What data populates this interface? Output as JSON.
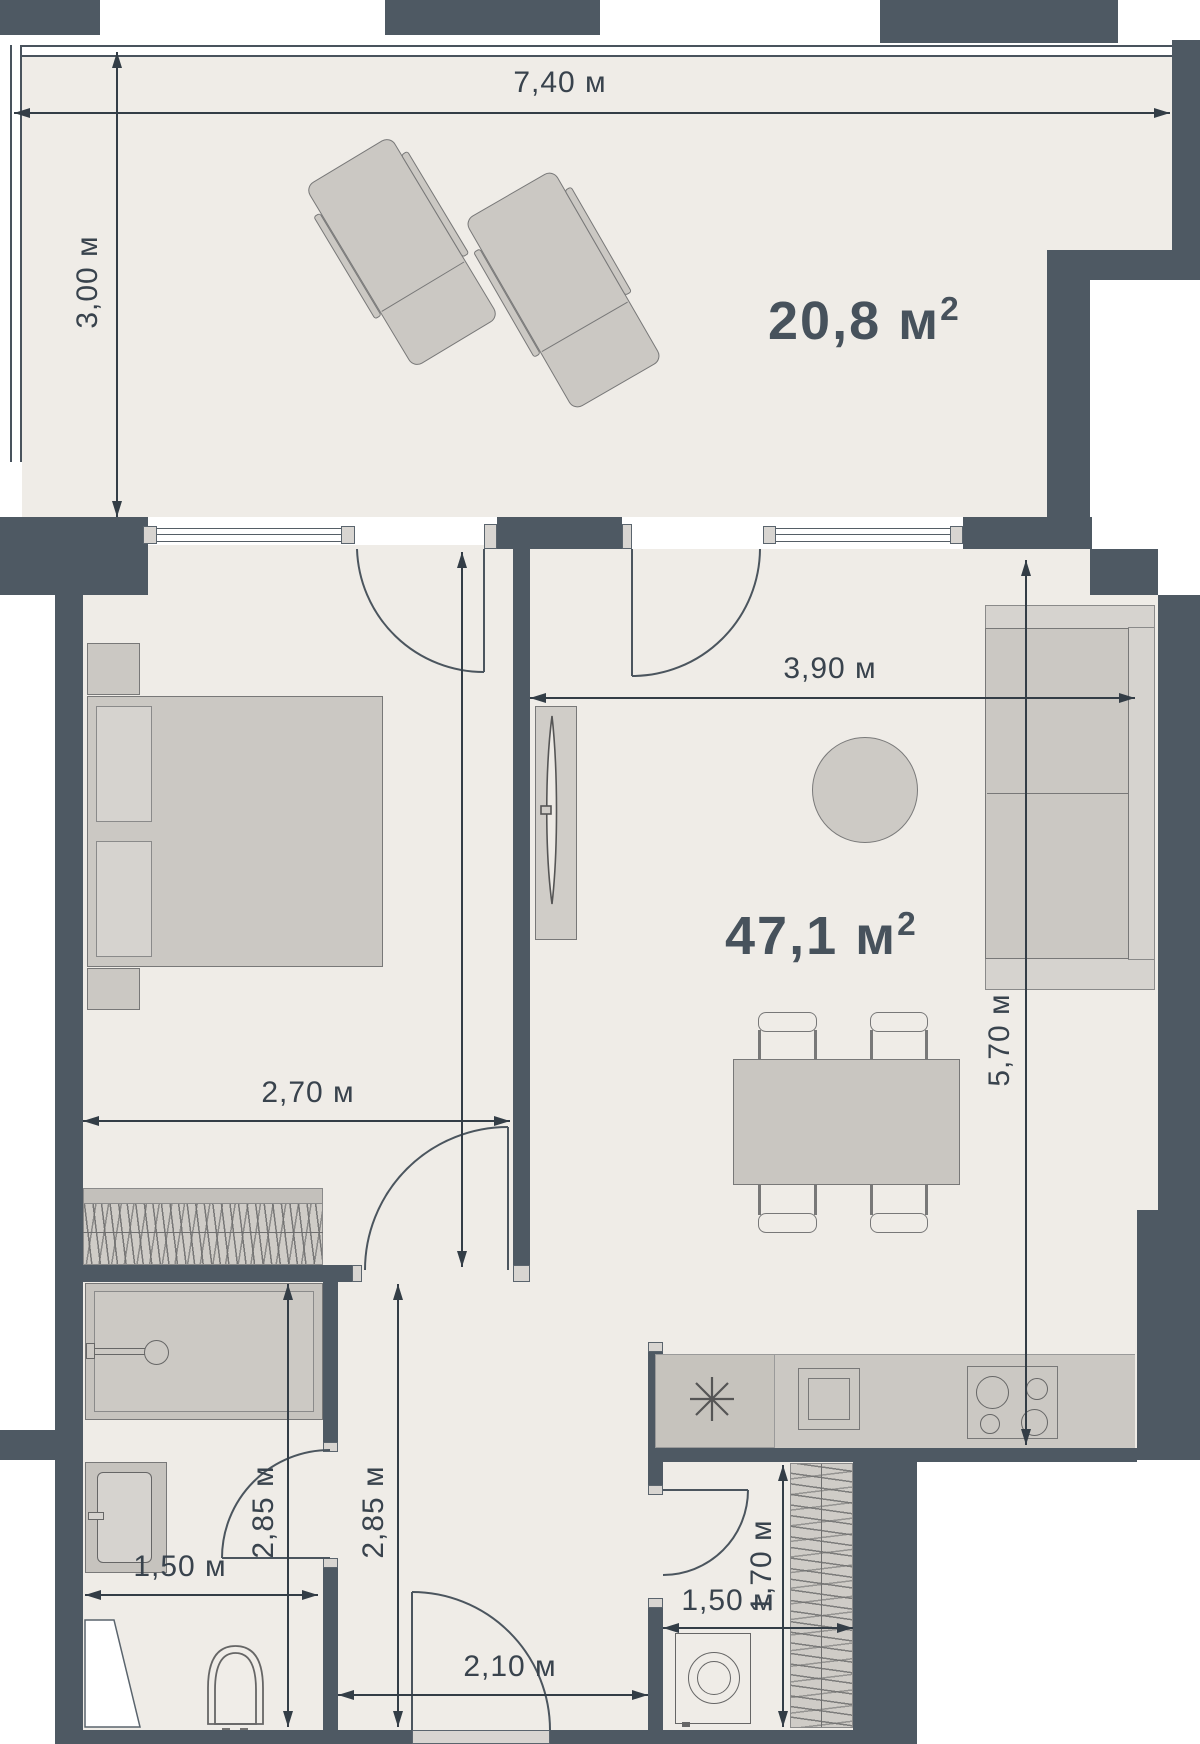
{
  "plan": {
    "type": "apartment-floor-plan",
    "areas": {
      "terrace": {
        "value": "20,8",
        "unit": "м",
        "sup": "2"
      },
      "living": {
        "value": "47,1",
        "unit": "м",
        "sup": "2"
      }
    },
    "dims": {
      "terrace_width": "7,40 м",
      "terrace_depth": "3,00 м",
      "living_width": "3,90 м",
      "living_depth": "5,70 м",
      "bedroom_width": "2,70 м",
      "bathroom_depth": "2,85 м",
      "hall_depth": "2,85 м",
      "bathroom_width": "1,50 м",
      "hall_width": "2,10 м",
      "laundry_width": "1,50 м",
      "laundry_depth": "1,70 м"
    },
    "colors": {
      "wall": "#4E5963",
      "floor": "#EFECE7",
      "furniture": "#CBC8C3",
      "furniture_light": "#D6D3CF",
      "door_cap": "#D8D5D1",
      "dimension": "#333D46",
      "label_text": "#47525C",
      "outside": "#FFFFFF"
    },
    "fixtures": [
      "lounger",
      "bed",
      "nightstand",
      "wardrobe",
      "tv",
      "rug",
      "sofa",
      "dining-table",
      "chair",
      "kitchen-counter",
      "sink",
      "oven",
      "hob",
      "washing-machine",
      "closet",
      "shower",
      "vanity",
      "toilet"
    ]
  }
}
